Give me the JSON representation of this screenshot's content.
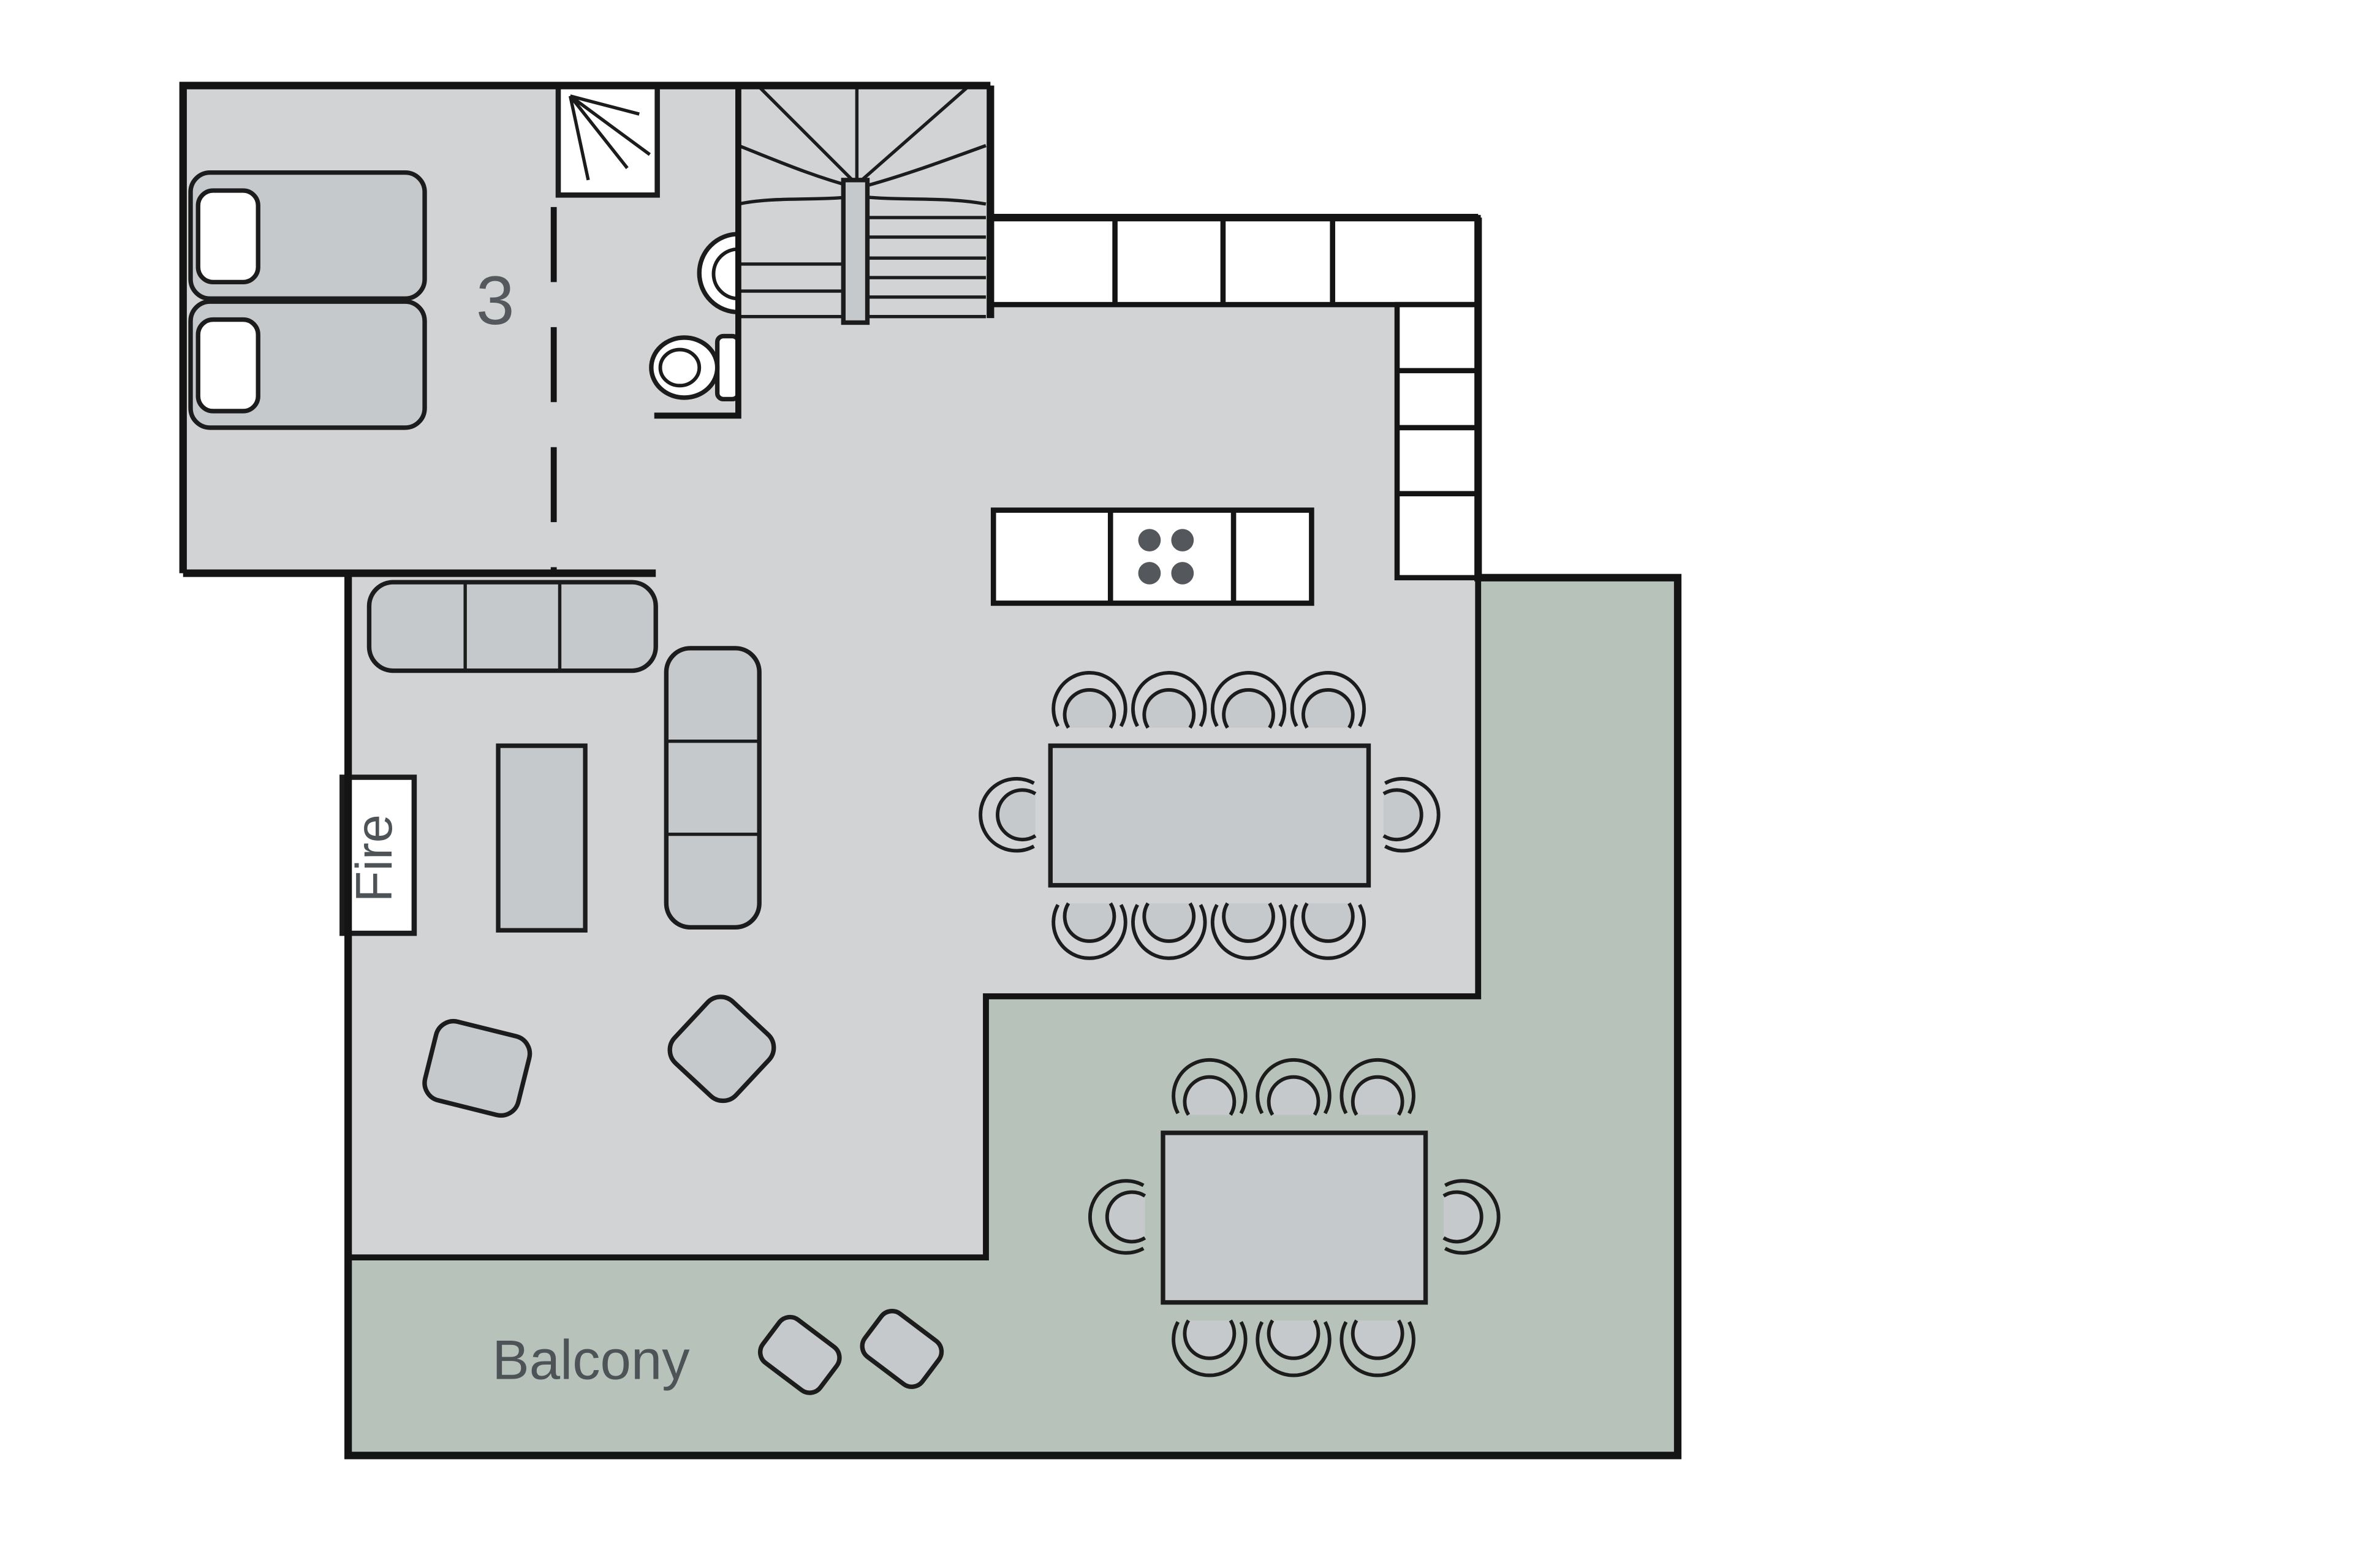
{
  "page": {
    "title": "Chalet Floor Plan"
  },
  "labels": {
    "bedroom_number": "3",
    "fireplace": "Fire",
    "balcony": "Balcony"
  },
  "colors": {
    "background": "#ffffff",
    "floor": "#d2d3d5",
    "balcony_floor": "#b7c2ba",
    "furniture": "#c6c9cb",
    "furniture_outline": "#1c1c1c",
    "wall": "#141414",
    "white_fixture": "#ffffff",
    "hob_burner": "#54575b",
    "label_text": "#4d5356",
    "room_number_text": "#55595d"
  },
  "rooms": {
    "bedroom": {
      "number_label": "3",
      "beds": 2,
      "pillows": 2
    },
    "bathroom": {
      "fixtures": [
        "shower-icon",
        "basin-icon",
        "toilet-icon"
      ]
    },
    "staircase": {
      "type": "u-shaped winder stairs"
    },
    "kitchen": {
      "counter_units_top_row": 4,
      "counter_units_side_column": 4,
      "island_units": 3,
      "hob_burners": 4
    },
    "living_dining": {
      "dining_seats": 10,
      "sofa_sections": 6,
      "armchairs": 2,
      "coffee_tables": 1,
      "fireplace_label": "Fire"
    },
    "balcony": {
      "label": "Balcony",
      "dining_seats": 8,
      "stools": 2
    }
  }
}
